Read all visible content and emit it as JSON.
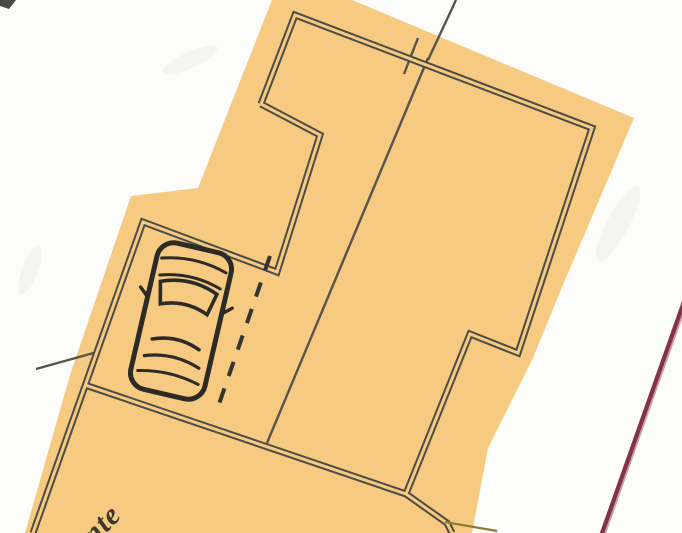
{
  "plan": {
    "title": "cadastral-site-plan-scan",
    "street_label": "nte",
    "icons": {
      "car": "car-top-view-icon"
    },
    "colors": {
      "paper": "#fcfcfa",
      "parcel_fill": "#f6ca81",
      "wall_stroke": "#4e4c46",
      "survey_line": "#56544b",
      "dashed_line": "#35342e",
      "car_stroke": "#2d2b26",
      "label_color": "#3a382f",
      "boundary_red_line": "#84314a",
      "olive_line": "#8f7d33",
      "scan_mark": "#4b4a46",
      "scan_smudge": "#8a8a85"
    }
  }
}
